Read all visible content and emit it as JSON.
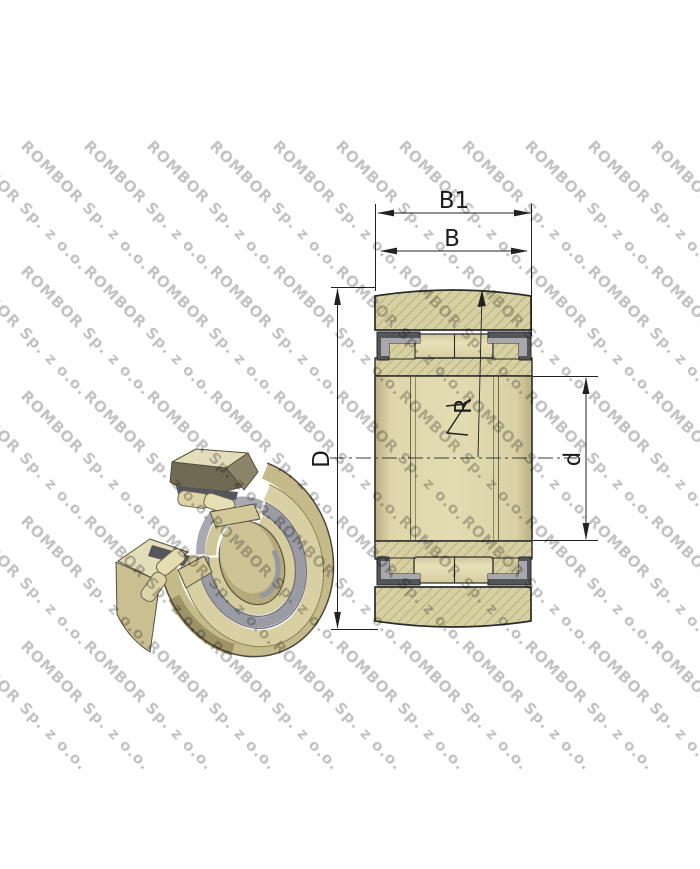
{
  "watermark": {
    "text": "ROMBOR Sp. z o.o.",
    "color": "#c3c3c3"
  },
  "figure": {
    "subject": "track-roller-bearing-technical-drawing",
    "dimensions": {
      "b1": "B1",
      "b": "B",
      "outer_diameter": "D",
      "bore_diameter": "d",
      "crown_radius": "R"
    },
    "colors": {
      "body_tan": "#d7d0a2",
      "hatch_line": "#9e9666",
      "roller_fill": "#e2dbb0",
      "seal_dark": "#54555b",
      "seal_light": "#a8a8ac",
      "outline": "#2b2b2b",
      "iso_gray_band": "#9b9ba4",
      "watermark_gray": "#c3c3c3"
    }
  }
}
